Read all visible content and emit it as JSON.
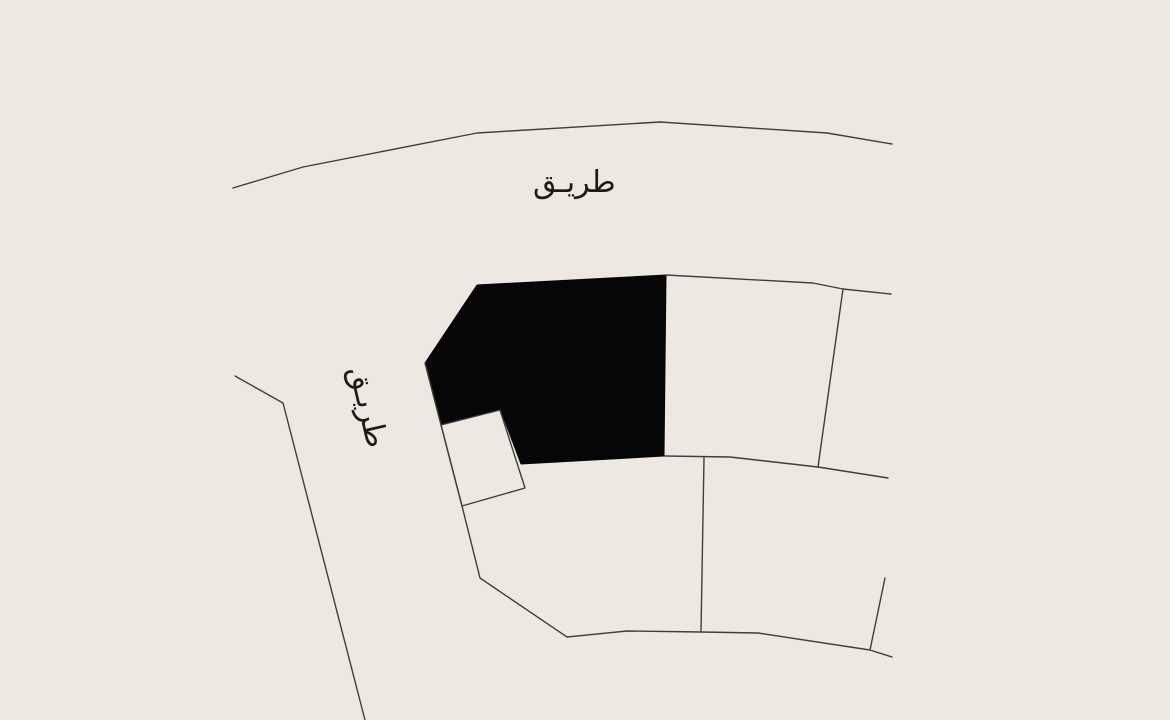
{
  "map": {
    "background_color": "#EDE9E2",
    "boundary_line_color": "#413E39",
    "highlighted_plot_color": "#060606",
    "label_color": "#1E1B17",
    "labels": {
      "road_top": {
        "text": "طريـق",
        "meaning": "road"
      },
      "road_left": {
        "text": "طريـق",
        "meaning": "road",
        "rotation_deg": 77
      }
    },
    "shapes": {
      "highlighted_plot": {
        "points": [
          [
            425,
            363
          ],
          [
            477,
            285
          ],
          [
            666,
            275
          ],
          [
            664,
            456
          ],
          [
            521,
            464
          ],
          [
            501,
            411
          ],
          [
            441,
            425
          ]
        ]
      },
      "small_plot": {
        "points": [
          [
            441,
            425
          ],
          [
            500,
            410
          ],
          [
            525,
            488
          ],
          [
            462,
            506
          ]
        ]
      }
    },
    "lines": [
      {
        "name": "road-edge-top",
        "points": [
          [
            233,
            188
          ],
          [
            303,
            167
          ],
          [
            477,
            133
          ],
          [
            660,
            122
          ],
          [
            827,
            133
          ],
          [
            892,
            144
          ]
        ]
      },
      {
        "name": "road-edge-left",
        "points": [
          [
            235,
            376
          ],
          [
            283,
            403
          ],
          [
            365,
            720
          ]
        ]
      },
      {
        "name": "boundary-west-south",
        "points": [
          [
            425,
            363
          ],
          [
            462,
            506
          ],
          [
            480,
            578
          ],
          [
            567,
            637
          ],
          [
            627,
            631
          ],
          [
            701,
            632
          ],
          [
            758,
            633
          ],
          [
            870,
            650
          ],
          [
            892,
            657
          ]
        ]
      },
      {
        "name": "parcel-top-boundary",
        "points": [
          [
            666,
            275
          ],
          [
            813,
            283
          ],
          [
            843,
            289
          ],
          [
            891,
            294
          ]
        ]
      },
      {
        "name": "parcel-right-divider",
        "points": [
          [
            843,
            289
          ],
          [
            818,
            467
          ]
        ]
      },
      {
        "name": "parcel-mid-boundary",
        "points": [
          [
            665,
            456
          ],
          [
            730,
            457
          ],
          [
            818,
            467
          ],
          [
            888,
            478
          ]
        ]
      },
      {
        "name": "parcel-lower-divider",
        "points": [
          [
            704,
            458
          ],
          [
            701,
            632
          ]
        ]
      },
      {
        "name": "parcel-corner-stub",
        "points": [
          [
            885,
            578
          ],
          [
            870,
            650
          ]
        ]
      }
    ]
  }
}
